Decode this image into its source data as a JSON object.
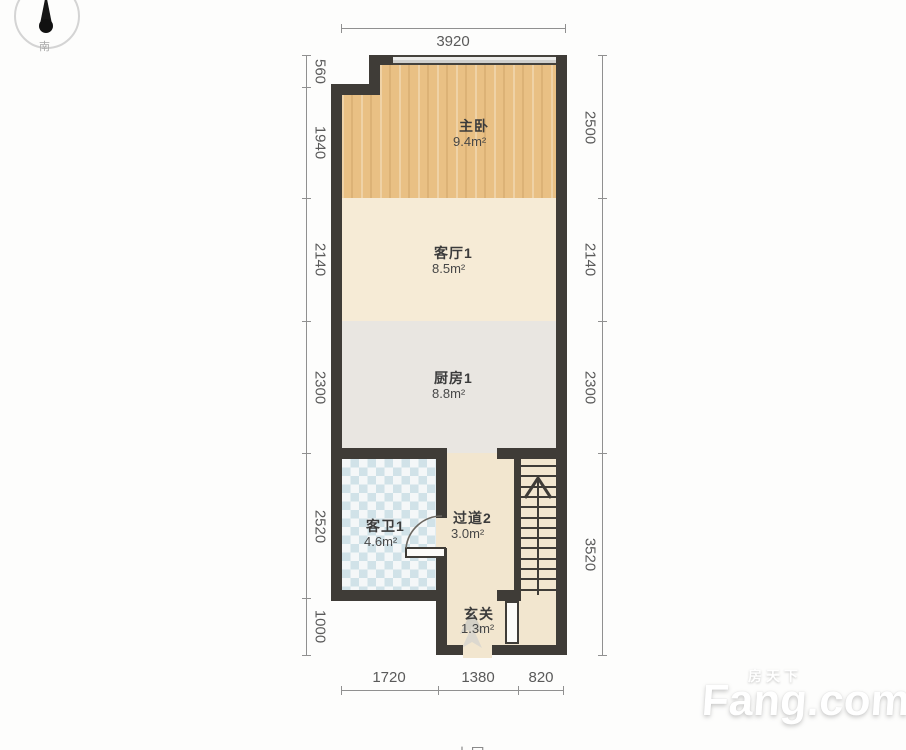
{
  "compass": {
    "south_label": "南"
  },
  "plan": {
    "rooms": [
      {
        "name": "主卧",
        "area": "9.4m²"
      },
      {
        "name": "客厅1",
        "area": "8.5m²"
      },
      {
        "name": "厨房1",
        "area": "8.8m²"
      },
      {
        "name": "客卫1",
        "area": "4.6m²"
      },
      {
        "name": "过道2",
        "area": "3.0m²"
      },
      {
        "name": "玄关",
        "area": "1.3m²"
      }
    ],
    "dimensions_mm": {
      "top": [
        "3920"
      ],
      "left": [
        "560",
        "1940",
        "2140",
        "2300",
        "2520",
        "1000"
      ],
      "right": [
        "2500",
        "2140",
        "2300",
        "3520"
      ],
      "bottom": [
        "1720",
        "1380",
        "820"
      ]
    }
  },
  "watermark": {
    "brand_cn": "房天下",
    "brand_en": "Fang.com"
  },
  "footer": {
    "clipped_floor_label": "上层"
  },
  "colors": {
    "wall": "#3f3c37",
    "bedroom_floor": "#e9c084",
    "living_floor": "#f6ebd6",
    "kitchen_floor": "#e9e6e1",
    "bath_floor": "#eef3f4",
    "hall_floor": "#f2e6cf",
    "dimension_line": "#909090",
    "dimension_text": "#5a5a5a"
  }
}
